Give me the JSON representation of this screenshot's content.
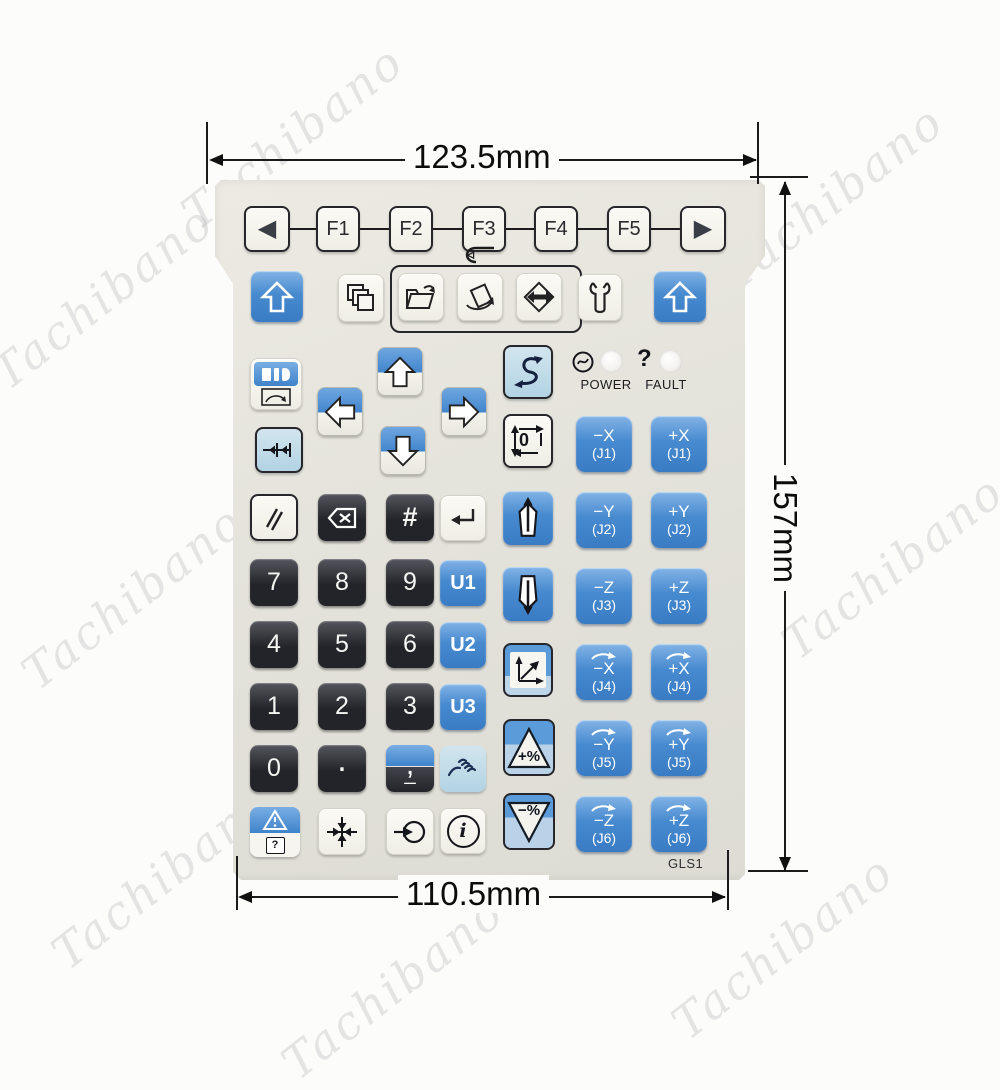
{
  "watermark": {
    "text": "Tachibano"
  },
  "dimensions": {
    "top": "123.5mm",
    "right": "157mm",
    "bottom": "110.5mm"
  },
  "panel": {
    "model": "GLS1",
    "nav": {
      "left": "◀",
      "right": "▶"
    },
    "fkeys": [
      "F1",
      "F2",
      "F3",
      "F4",
      "F5"
    ],
    "indicators": {
      "power": "POWER",
      "fault": "FAULT",
      "fault_mark": "?"
    },
    "numpad": [
      [
        "7",
        "8",
        "9"
      ],
      [
        "4",
        "5",
        "6"
      ],
      [
        "1",
        "2",
        "3"
      ]
    ],
    "zero": "0",
    "dot": ".",
    "comma": ",",
    "underscore": "_",
    "hash": "#",
    "ukeys": [
      "U1",
      "U2",
      "U3"
    ],
    "cycle_zero": "0",
    "percent_up": "+%",
    "percent_down": "−%",
    "info": "i",
    "help_mark": "?",
    "jog": [
      {
        "label": "−X",
        "sub": "(J1)"
      },
      {
        "label": "+X",
        "sub": "(J1)"
      },
      {
        "label": "−Y",
        "sub": "(J2)"
      },
      {
        "label": "+Y",
        "sub": "(J2)"
      },
      {
        "label": "−Z",
        "sub": "(J3)"
      },
      {
        "label": "+Z",
        "sub": "(J3)"
      },
      {
        "label": "−X",
        "sub": "(J4)"
      },
      {
        "label": "+X",
        "sub": "(J4)"
      },
      {
        "label": "−Y",
        "sub": "(J5)"
      },
      {
        "label": "+Y",
        "sub": "(J5)"
      },
      {
        "label": "−Z",
        "sub": "(J6)"
      },
      {
        "label": "+Z",
        "sub": "(J6)"
      }
    ],
    "icon_names": [
      "shift-up",
      "pages",
      "open-folder",
      "export-program",
      "io-transfer",
      "wrench",
      "display-select",
      "arrow-up",
      "arrow-down",
      "arrow-left",
      "arrow-right",
      "step-forward",
      "s-curve-jog",
      "cycle-zero",
      "double-slash",
      "backspace",
      "enter",
      "jog-shield-up",
      "jog-shield-down",
      "axes",
      "hand-touch",
      "warning-help",
      "center-crosshair",
      "loop-return",
      "info",
      "power-circle"
    ],
    "colors": {
      "blue": "#4588cf",
      "light_blue": "#b9d8e6",
      "key_black": "#2b2c31",
      "panel": "#e4e3dc",
      "led": "#ffffff",
      "outline": "#26262b"
    }
  }
}
